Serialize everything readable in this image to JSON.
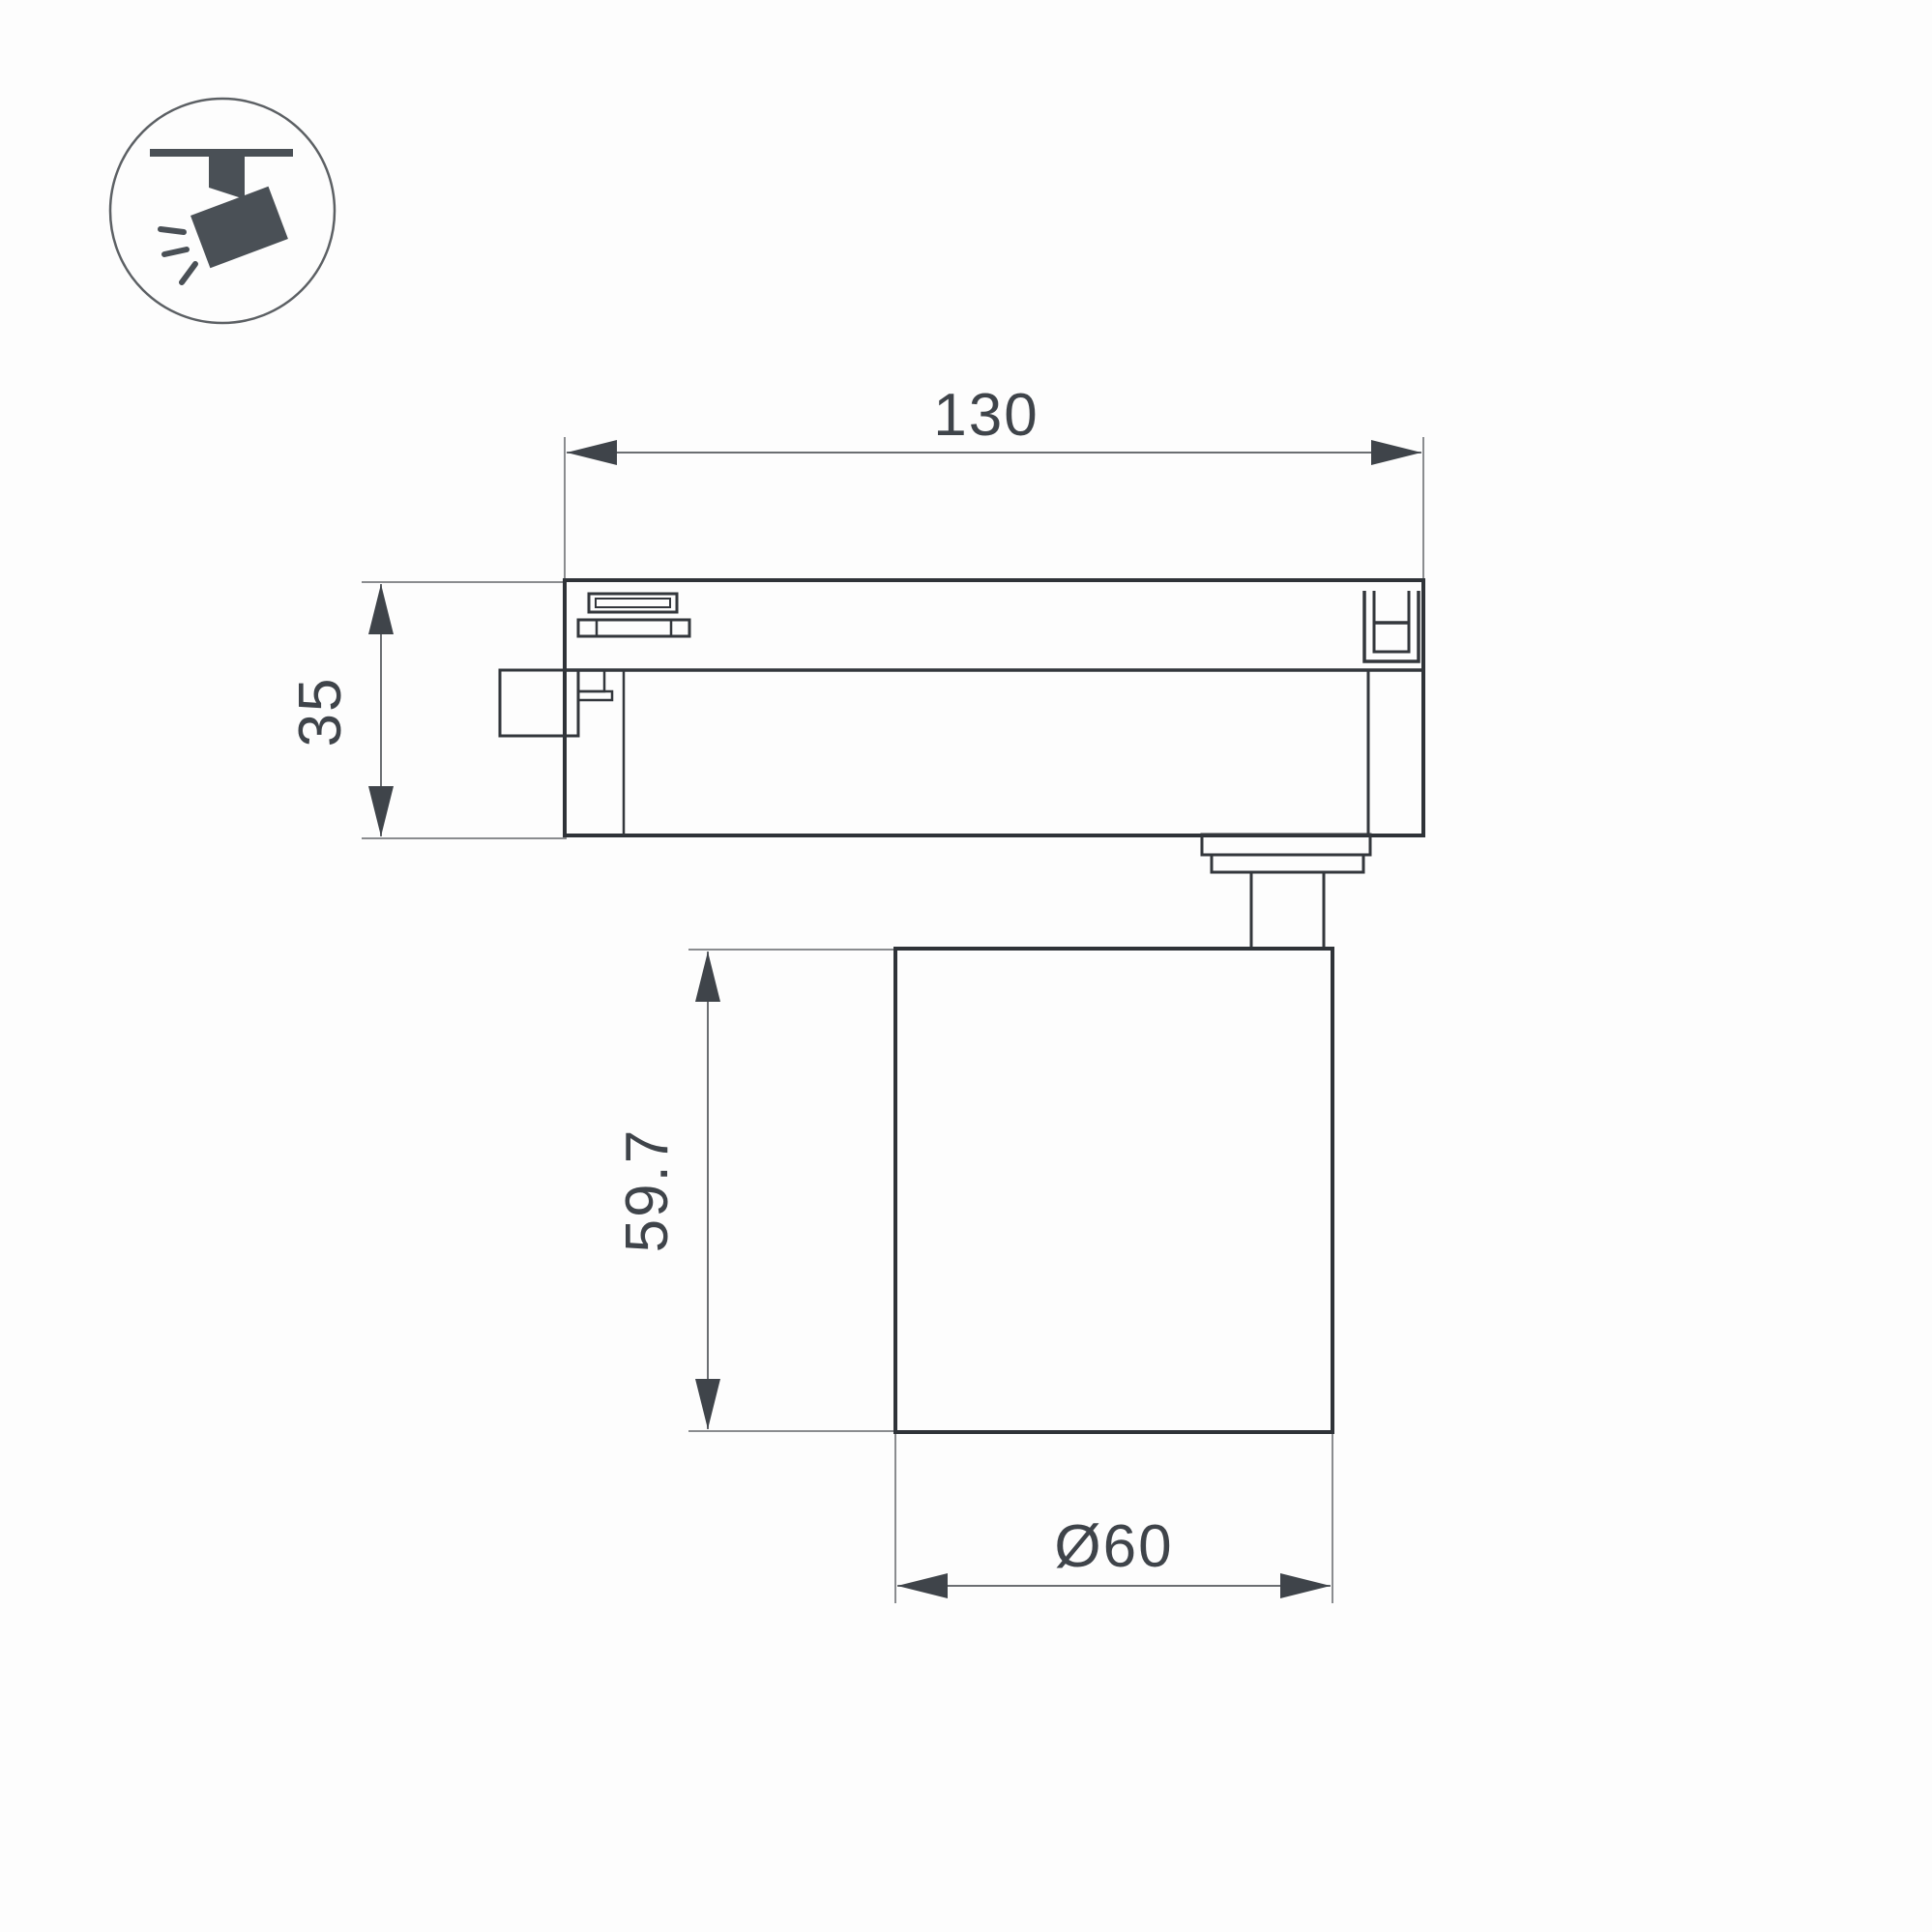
{
  "drawing": {
    "kind": "technical-dimension-drawing",
    "subject": "ceiling track spotlight side view",
    "background_color": "#fdfdfd",
    "outline_color": "#2f3338",
    "extension_line_color": "#8a8c8f",
    "arrow_color": "#3f444a",
    "text_color": "#3f444a",
    "icon_color": "#4a5056"
  },
  "icon": {
    "name": "ceiling-track-spotlight"
  },
  "dimensions": {
    "track_width": {
      "label": "130",
      "orientation": "horizontal"
    },
    "track_height": {
      "label": "35",
      "orientation": "vertical"
    },
    "body_height": {
      "label": "59.7",
      "orientation": "vertical"
    },
    "body_diameter": {
      "label": "Ø60",
      "orientation": "horizontal"
    }
  }
}
